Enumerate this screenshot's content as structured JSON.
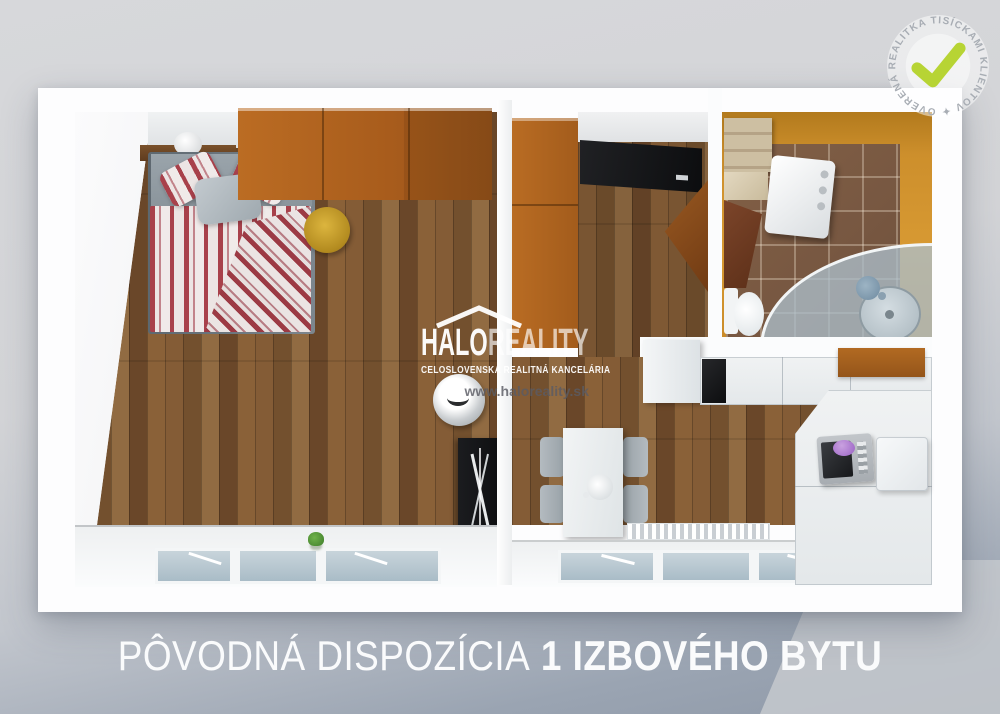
{
  "watermark": {
    "brand_part1": "HALO",
    "brand_part2": "REALITY",
    "subtitle": "CELOSLOVENSKÁ REALITNÁ KANCELÁRIA",
    "url": "www.haloreality.sk",
    "roof_icon": "house-roof-icon"
  },
  "badge": {
    "circular_text": "OVERENÁ REALITKA TISÍCKAMI KLIENTOV ✦",
    "check_icon": "checkmark-icon",
    "check_color": "#b7d434"
  },
  "caption": {
    "regular": "PÔVODNÁ DISPOZÍCIA",
    "bold": "1 IZBOVÉHO BYTU"
  },
  "colors": {
    "accent_lime": "#b7d434",
    "wardrobe_orange": "#b0641f",
    "bathroom_wall": "#cf8f2e",
    "wood_mid": "#7d5733",
    "duvet_red": "#a8414b",
    "backdrop_top": "#d7d8db",
    "backdrop_bottom": "#8f99a8"
  }
}
